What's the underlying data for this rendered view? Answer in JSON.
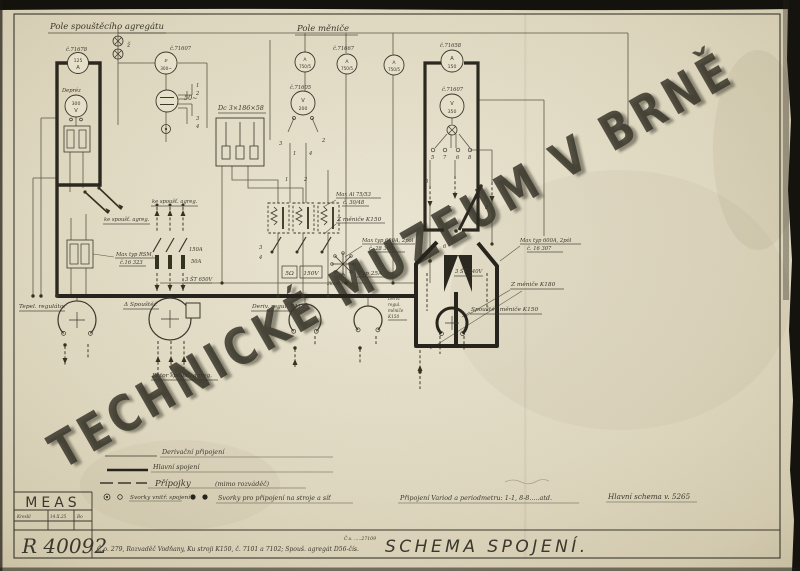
{
  "watermark": "TECHNICKÉ MUZEUM V BRNĚ",
  "colors": {
    "paper": "#e2dbc3",
    "ink": "#3a372c",
    "watermark": "#faf8ee"
  },
  "titles": {
    "starter_field": "Pole spouštěcího agregátu",
    "converter_field": "Pole měniče"
  },
  "instruments": {
    "am71678": {
      "label": "č.71678",
      "top": "125",
      "bottom": "A"
    },
    "deprez": {
      "label": "Depréz",
      "top": "300",
      "bottom": "V"
    },
    "lamp": "ž",
    "freq71607": {
      "label": "č.71607",
      "top": "ν",
      "bottom": "300~"
    },
    "sync": "50~",
    "dc_block": "Dc 3×186×58",
    "v71605": {
      "label": "č.71605",
      "top": "V",
      "bottom": "200"
    },
    "a750_left": {
      "top": "A",
      "bottom": "750/5"
    },
    "a71667": {
      "label": "č.71667",
      "top": "A",
      "bottom": "750/5"
    },
    "a750_right": {
      "top": "A",
      "bottom": "750/5"
    },
    "am71658": {
      "label": "č.71658",
      "top": "A",
      "bottom": "150"
    },
    "v71607b": {
      "label": "č.71607",
      "top": "V",
      "bottom": "350"
    }
  },
  "terminals": {
    "t1": "1",
    "t2": "2",
    "t3": "3",
    "t4": "4",
    "t5": "5",
    "t6": "6",
    "t7": "7",
    "t8": "8"
  },
  "labels": {
    "to_starter_left": "ke spoušť. agreg.",
    "to_starter_mid": "ke spoušť. agreg.",
    "rsm1": "Max typ RSM,",
    "rsm2": "č.16 323",
    "fuse150": "150A",
    "fuse50": "50A",
    "fuse650": "3 ŠT 650V",
    "al1": "Max Al 75/53",
    "al2": "č. 30/48",
    "from_k150": "Z měniče K150",
    "from_k180": "Z měniče K180",
    "max600a1": "Max typ 600A, 2pól",
    "max600a2": "č. 28 309",
    "max600b1": "Max typ 600A, 2pól",
    "max600b2": "č. 16 307",
    "ohm5": "5Ω",
    "v150": "150V",
    "ks2": "2ks 6",
    "typ25": "Typ 25A",
    "st240": "3 ŠT 240V"
  },
  "machines": {
    "tepel": "Tepel. regulátor",
    "delta": "Δ Spouštěč",
    "rotor": "Rotor spoušť. agreg.",
    "deriv7415": "Deriv. regul. 7415",
    "dk1": "Deriv.",
    "dk2": "regul.",
    "dk3": "měniče",
    "dk4": "K150",
    "starter_k150": "Spouštěč měniče K150"
  },
  "legend": {
    "deriv": "Derivační připojení",
    "main": "Hlavní spojení",
    "ext": "Přípojky",
    "ext2": "(mimo rozváděč)",
    "terminals_int": "Svorky vnitř. spojení",
    "terminals_ext": "Svorky pro připojení na stroje a síť",
    "variod": "Připojení Variod a periodmetru: 1-1, 8-8.....atd.",
    "main_schema": "Hlavní schema v. 5265"
  },
  "title_block": {
    "company": "MEAS",
    "kreslil": "Kreslil",
    "date": "14.X.25",
    "initials": "Bo",
    "number": "R 40092",
    "subject": "Č.o. 279, Rozvaděč Vodňany, Ku stroji K150, č. 7101 a 7102; Spouš. agregát D56-čís.",
    "cs_note": "Č.s. .....27109",
    "title": "SCHEMA SPOJENÍ."
  }
}
